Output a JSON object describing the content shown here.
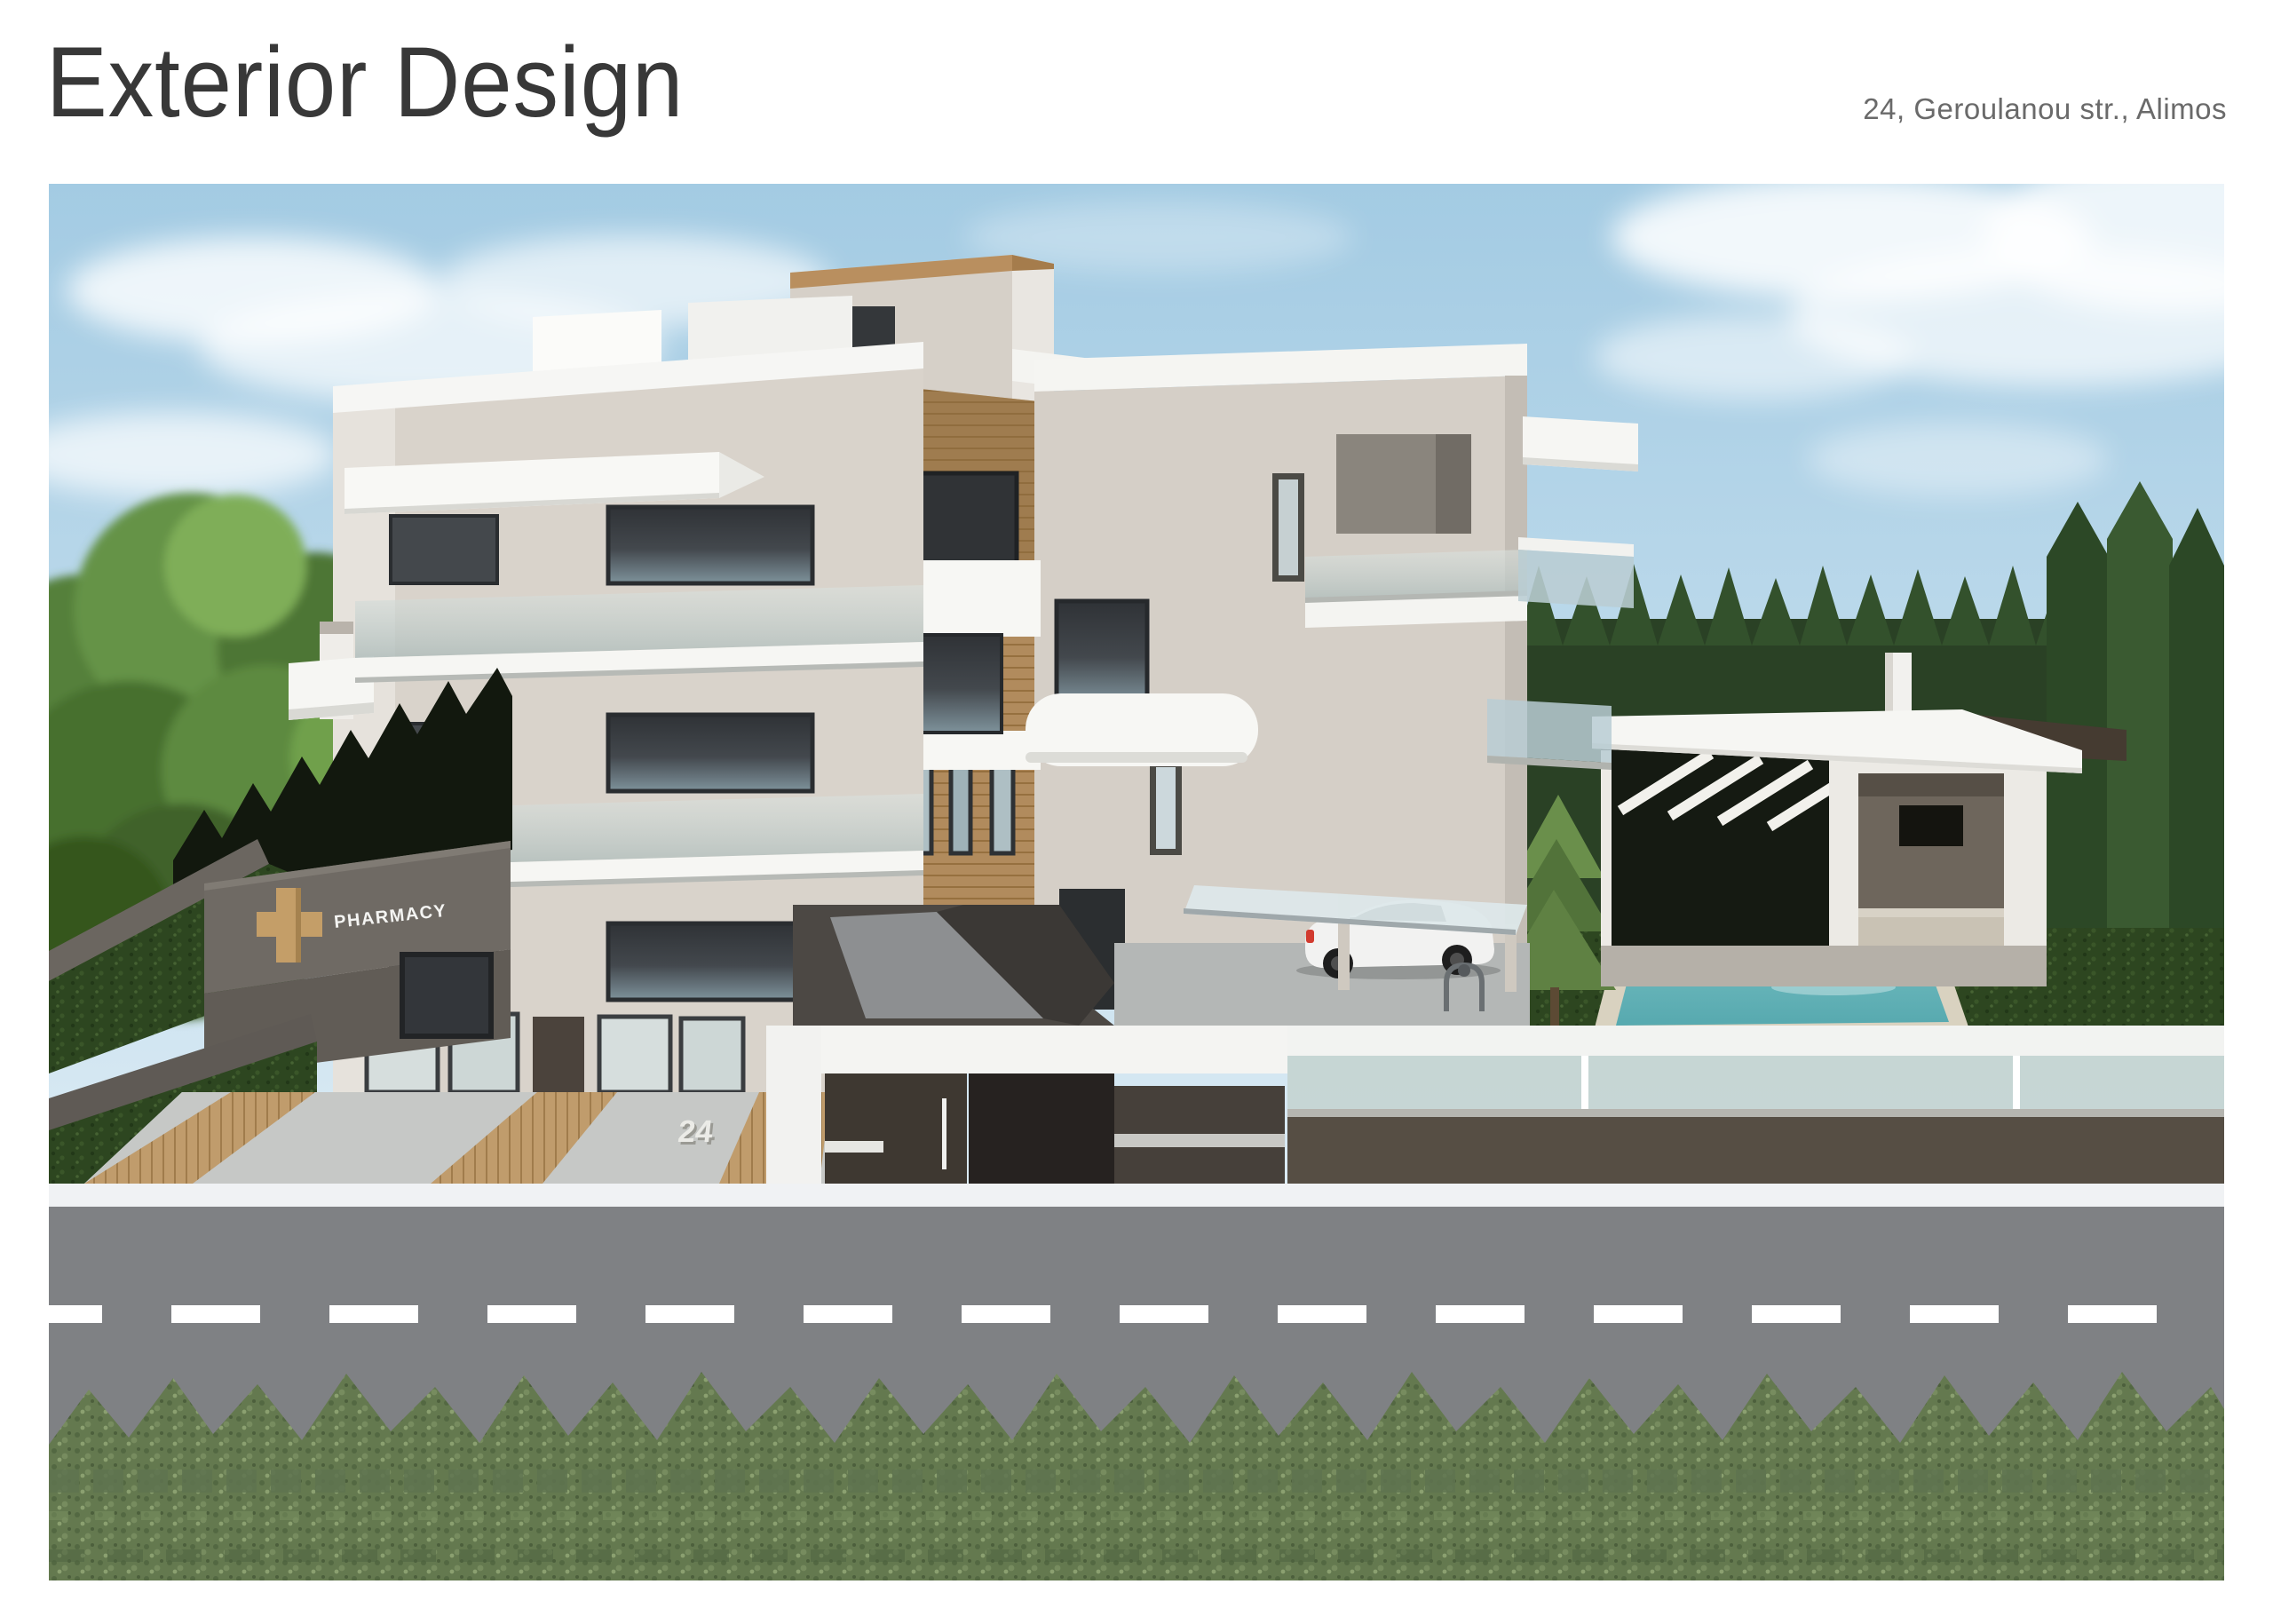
{
  "page": {
    "title": "Exterior Design",
    "address": "24, Geroulanou str., Alimos"
  },
  "scene": {
    "pharmacy_sign_label": "PHARMACY",
    "house_number": "24",
    "colors": {
      "sky_top": "#a3cbe3",
      "sky_bottom": "#ddecf5",
      "facade_beige": "#d9d3cb",
      "facade_side_light": "#e6e2dc",
      "trim_white": "#f6f6f4",
      "wood_cladding": "#b18b5d",
      "window_glass_dark": "#35383c",
      "window_glass_light": "#c9d6d9",
      "pharmacy_wall": "#6f6a64",
      "pharmacy_cross_wood": "#c49e68",
      "grass_dark": "#2d4620",
      "hedge_green": "#2a4125",
      "pool_water": "#6fbcbe",
      "pool_deck": "#d9d2c0",
      "road_gray": "#7f8184",
      "lane_marking": "#ffffff",
      "sidewalk": "#f0f2f4",
      "fence_dark": "#564e44",
      "gate_dark": "#3e3831",
      "bush_green": "#64794f",
      "car_body": "#f2f2f1",
      "car_taillight": "#d23b2f"
    }
  }
}
